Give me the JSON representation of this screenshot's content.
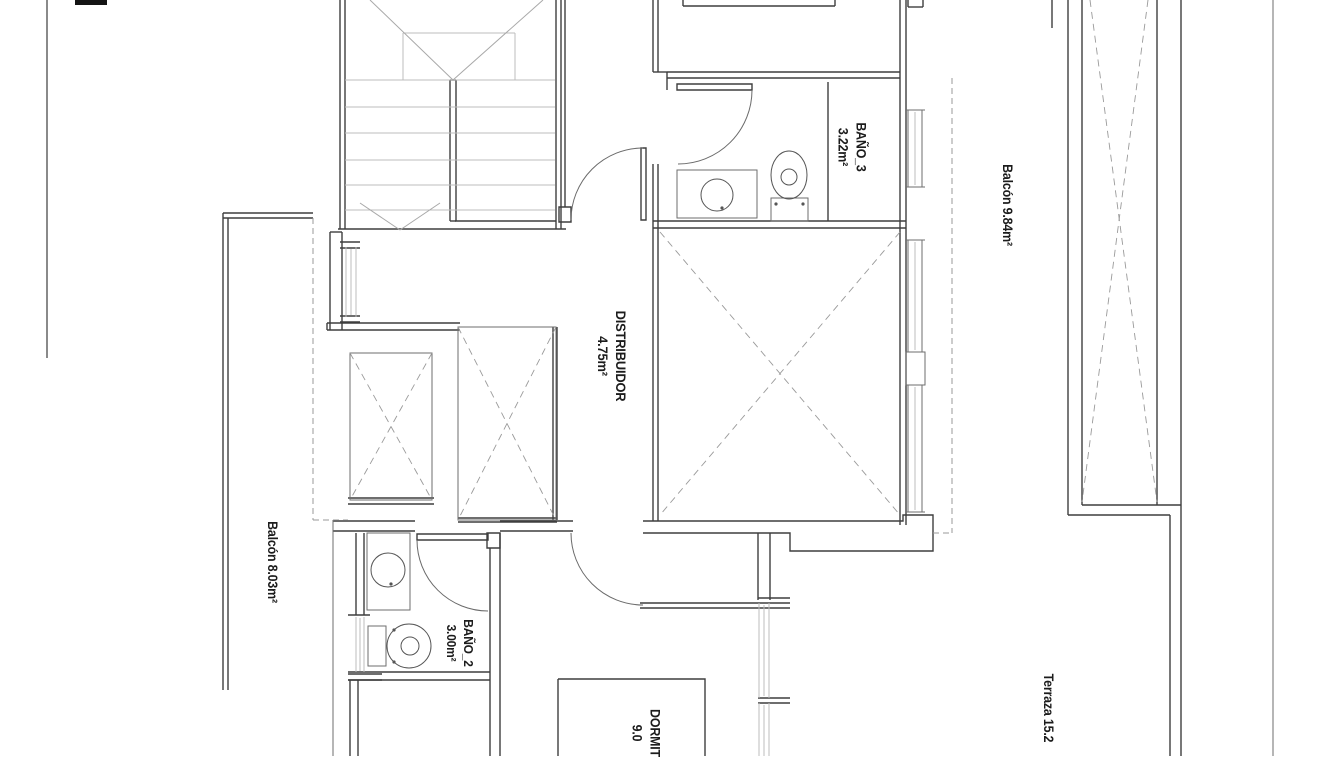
{
  "document": {
    "title": "Planta - plano de vivienda",
    "type": "architectural floor plan"
  },
  "floorplan": {
    "canvas": {
      "width": 1319,
      "height": 756,
      "background": "#ffffff"
    },
    "rooms": [
      {
        "id": "bano3",
        "name": "BAÑO_3",
        "area": "3.22m²"
      },
      {
        "id": "distribuidor",
        "name": "DISTRIBUIDOR",
        "area": "4.75m²"
      },
      {
        "id": "balcon-right",
        "name": "Balcón",
        "area": "9.84m²"
      },
      {
        "id": "balcon-left",
        "name": "Balcón",
        "area": "8.03m²"
      },
      {
        "id": "bano2",
        "name": "BAÑO_2",
        "area": "3.00m²"
      },
      {
        "id": "dormitorio",
        "name": "DORMIT",
        "area": "9.0"
      },
      {
        "id": "terraza",
        "name": "Terraza",
        "area": "15.2"
      }
    ],
    "labels": [
      {
        "name": "label-bano3",
        "lines": [
          "BAÑO_3",
          "3.22m²"
        ],
        "x": 852,
        "y": 147,
        "size": 13.5,
        "rotation": 90
      },
      {
        "name": "label-distribuidor",
        "lines": [
          "DISTRIBUIDOR",
          "4.75m²"
        ],
        "x": 612,
        "y": 356,
        "size": 14,
        "rotation": 90
      },
      {
        "name": "label-balcon-right",
        "lines": [
          "Balcón 9.84m²"
        ],
        "x": 1007,
        "y": 205,
        "size": 13.5,
        "rotation": 90
      },
      {
        "name": "label-balcon-left",
        "lines": [
          "Balcón 8.03m²"
        ],
        "x": 272,
        "y": 562,
        "size": 13.5,
        "rotation": 90
      },
      {
        "name": "label-bano2",
        "lines": [
          "BAÑO_2",
          "3.00m²"
        ],
        "x": 459,
        "y": 643,
        "size": 13,
        "rotation": 90
      },
      {
        "name": "label-dormitorio",
        "lines": [
          "DORMIT",
          "9.0"
        ],
        "x": 646,
        "y": 733,
        "size": 13.5,
        "rotation": 90
      },
      {
        "name": "label-terraza",
        "lines": [
          "Terraza 15.2"
        ],
        "x": 1048,
        "y": 708,
        "size": 13.5,
        "rotation": 90
      }
    ],
    "colors": {
      "wall": "#3e3e3e",
      "medium": "#6e6e6e",
      "light": "#bcbcbc",
      "diagonal": "#a8a8a8",
      "dashed": "#999999",
      "arc": "#6a6a6a",
      "fixture": "#555555",
      "black_fill": "#141414",
      "border": "#8a8a8a"
    },
    "layers": [
      {
        "name": "page-border-line",
        "stroke": "#8a8a8a",
        "width": 2,
        "paths": [
          "M47,0 V358"
        ]
      },
      {
        "name": "solid-black-marker",
        "stroke": "none",
        "fill": "#141414",
        "rects": [
          {
            "x": 75,
            "y": 0,
            "w": 32,
            "h": 5
          }
        ]
      },
      {
        "name": "walls-dark",
        "stroke": "#3e3e3e",
        "width": 1.4,
        "paths": [
          "M340,0 V229",
          "M345,0 V229",
          "M556,0 V229",
          "M561,0 V229",
          "M565,0 V207",
          "M338,229 H566",
          "M455,221 H556",
          "M450,80 V221",
          "M456,80 V221",
          "M450,80 H456",
          "M450,221 H456",
          "M559,207 H571 V222 H559 Z",
          "M641,148 H646 V220 H641 Z",
          "M683,0 V6",
          "M835,0 V6",
          "M683,6 H835",
          "M908,0 V7",
          "M923,0 V7",
          "M908,7 H923",
          "M900,0 V525",
          "M906,0 V525",
          "M667,72 H900",
          "M667,78 H900",
          "M653,0 V72",
          "M658,0 V72",
          "M653,72 H667",
          "M667,72 V90",
          "M677,84 H752 V90 H677 Z",
          "M653,164 V521",
          "M658,164 V521",
          "M653,221 H906",
          "M653,228 H906",
          "M828,82 V221",
          "M333,521 H415",
          "M333,531 H415",
          "M500,521 H573",
          "M500,531 H573",
          "M643,521 H903 V515 H933 V551 H790 V533 H643",
          "M487,533 H500 V548 H487 Z",
          "M490,548 V756",
          "M500,533 V756",
          "M417,534 H488 V540 H417 Z",
          "M348,672 H490",
          "M348,680 H490",
          "M356,533 V615",
          "M364,533 V615",
          "M348,615 H370",
          "M348,674 H382",
          "M348,680 H382",
          "M350,680 V756",
          "M358,680 V756",
          "M330,232 V330",
          "M342,232 V330",
          "M330,232 H342",
          "M340,242 H360",
          "M340,248 H360",
          "M340,316 H360",
          "M340,322 H360",
          "M327,323 H460",
          "M327,330 H460",
          "M327,323 V330",
          "M348,498 H434",
          "M348,504 H434",
          "M553,327 V520",
          "M557,327 V520",
          "M458,518 H557",
          "M458,522 H557",
          "M223,213 V690",
          "M228,218 V690",
          "M223,213 H313",
          "M223,218 H313",
          "M640,603 H790",
          "M640,608 H790",
          "M758,533 V600",
          "M770,533 V600",
          "M758,598 H790",
          "M758,698 H790",
          "M758,703 H790",
          "M1068,0 V515",
          "M1082,0 V505",
          "M1157,0 V505",
          "M1181,0 V756",
          "M1170,515 V756",
          "M1082,505 H1181",
          "M1068,515 H1170",
          "M1052,0 V28",
          "M558,679 H705 V760",
          "M558,679 V760"
        ]
      },
      {
        "name": "walls-medium",
        "stroke": "#6e6e6e",
        "width": 1,
        "paths": [
          "M333,520 V756",
          "M1273,0 V756",
          "M906,110 H925",
          "M906,187 H925",
          "M908,110 V187",
          "M922,110 V187",
          "M906,240 H925",
          "M906,352 H925",
          "M908,240 V352",
          "M922,240 V352",
          "M906,352 H925 V385 H906 Z",
          "M906,385 H925",
          "M906,512 H925",
          "M908,385 V512",
          "M922,385 V512",
          "M350,353 H432 V500 H350 Z",
          "M458,327 H556 V520 H458 Z",
          "M677,170 H757 V218 H677 Z",
          "M771,198 H808 V221 H771 Z",
          "M367,533 H410 V610 H367 Z",
          "M368,626 H386 V666 H368 Z"
        ]
      },
      {
        "name": "stair-treads-light",
        "stroke": "#bcbcbc",
        "width": 1,
        "paths": [
          "M345,80 H555",
          "M345,107 H555",
          "M345,133 H555",
          "M345,160 H555",
          "M345,185 H555",
          "M345,210 H555",
          "M403,33 H515",
          "M403,33 V80",
          "M515,33 V80",
          "M915,112 V185",
          "M915,242 V350",
          "M915,387 V510",
          "M346,247 V317",
          "M356,247 V317",
          "M351,249 V315",
          "M356,617 V672",
          "M364,617 V672",
          "M360,618 V671",
          "M759,603 V698",
          "M769,603 V698",
          "M764,605 V696",
          "M759,703 V756",
          "M769,703 V756",
          "M764,705 V756"
        ]
      },
      {
        "name": "stair-diagonals",
        "stroke": "#a8a8a8",
        "width": 1,
        "paths": [
          "M370,0 L453,80",
          "M543,0 L453,80",
          "M360,203 L400,230",
          "M440,203 L400,230"
        ]
      },
      {
        "name": "cross-braces-dashed",
        "stroke": "#9a9a9a",
        "width": 0.9,
        "dash": "7,5",
        "paths": [
          "M660,232 L900,515",
          "M900,232 L660,515",
          "M350,353 L432,500",
          "M432,353 L350,500",
          "M458,327 L556,520",
          "M556,327 L458,520",
          "M1090,0 L1157,502",
          "M1148,0 L1082,502"
        ]
      },
      {
        "name": "overhang-dashed",
        "stroke": "#999999",
        "width": 1,
        "dash": "6,4",
        "paths": [
          "M313,218 V520",
          "M313,520 H348",
          "M952,78 V533",
          "M933,533 H952"
        ]
      },
      {
        "name": "door-arcs",
        "stroke": "#6a6a6a",
        "width": 1,
        "paths": [
          "M643,148 A72,72 0 0 0 571,220",
          "M752,90 A74,74 0 0 1 678,164",
          "M417,540 A71,71 0 0 0 488,611",
          "M571,533 A72,72 0 0 0 643,605"
        ]
      },
      {
        "name": "fixtures",
        "stroke": "#555555",
        "width": 1,
        "circles": [
          {
            "cx": 717,
            "cy": 195,
            "r": 16
          },
          {
            "cx": 789,
            "cy": 177,
            "r": 8
          },
          {
            "cx": 388,
            "cy": 570,
            "r": 17
          },
          {
            "cx": 410,
            "cy": 646,
            "r": 9
          }
        ],
        "ellipses": [
          {
            "cx": 789,
            "cy": 175,
            "rx": 18,
            "ry": 24
          },
          {
            "cx": 409,
            "cy": 646,
            "rx": 22,
            "ry": 22
          }
        ],
        "dots": [
          {
            "cx": 722,
            "cy": 208,
            "r": 1.6
          },
          {
            "cx": 776,
            "cy": 204,
            "r": 1.6
          },
          {
            "cx": 803,
            "cy": 204,
            "r": 1.6
          },
          {
            "cx": 391,
            "cy": 584,
            "r": 1.6
          },
          {
            "cx": 394,
            "cy": 630,
            "r": 1.6
          },
          {
            "cx": 394,
            "cy": 662,
            "r": 1.6
          }
        ]
      }
    ]
  }
}
